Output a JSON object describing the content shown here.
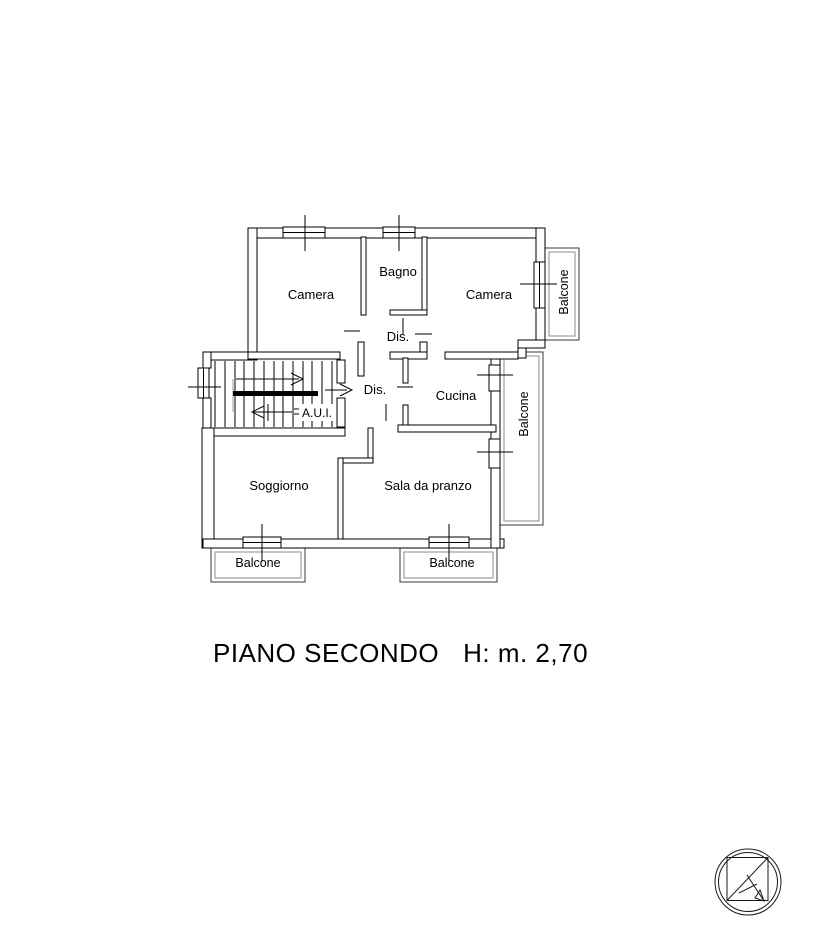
{
  "plan": {
    "rooms": {
      "camera_left": "Camera",
      "bagno": "Bagno",
      "camera_right": "Camera",
      "dis_upper": "Dis.",
      "dis_lower": "Dis.",
      "cucina": "Cucina",
      "aui": "A.U.I.",
      "soggiorno": "Soggiorno",
      "sala_da_pranzo": "Sala da pranzo"
    },
    "balconies": {
      "right_top": "Balcone",
      "right_middle": "Balcone",
      "bottom_left": "Balcone",
      "bottom_right": "Balcone"
    }
  },
  "caption": {
    "floor": "PIANO SECONDO",
    "height": "H: m. 2,70"
  },
  "icons": {
    "logo": "north-arrow-compass-icon"
  },
  "colors": {
    "line": "#000000",
    "line_secondary": "#8a8a8a",
    "background": "#ffffff"
  }
}
